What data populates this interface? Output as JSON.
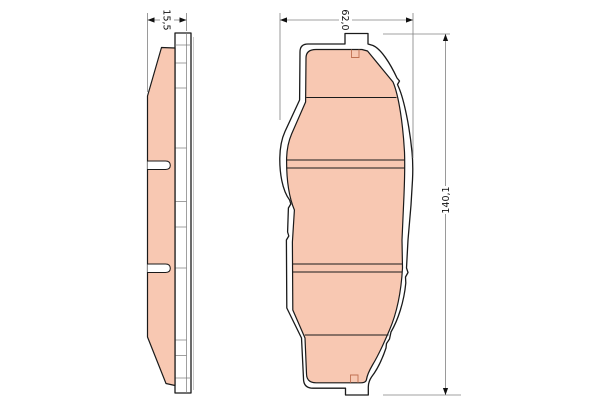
{
  "page": {
    "title": "Brake pad set technical drawing"
  },
  "views": [
    {
      "id": "side-view"
    },
    {
      "id": "front-view"
    }
  ],
  "dimensions": [
    {
      "id": "pad-thickness",
      "label": "15,5",
      "orientation": "horizontal",
      "view": "side-view"
    },
    {
      "id": "pad-width",
      "label": "62,0",
      "orientation": "horizontal",
      "view": "front-view"
    },
    {
      "id": "pad-height",
      "label": "140,1",
      "orientation": "vertical",
      "view": "front-view"
    }
  ],
  "colors": {
    "background": "#ffffff",
    "friction_material": "#f8c8b2",
    "outline": "#1a1a1a",
    "detail_line": "#777777",
    "dimension_line": "#808080",
    "dimension_text": "#111111",
    "marker_line": "#bf7152"
  }
}
